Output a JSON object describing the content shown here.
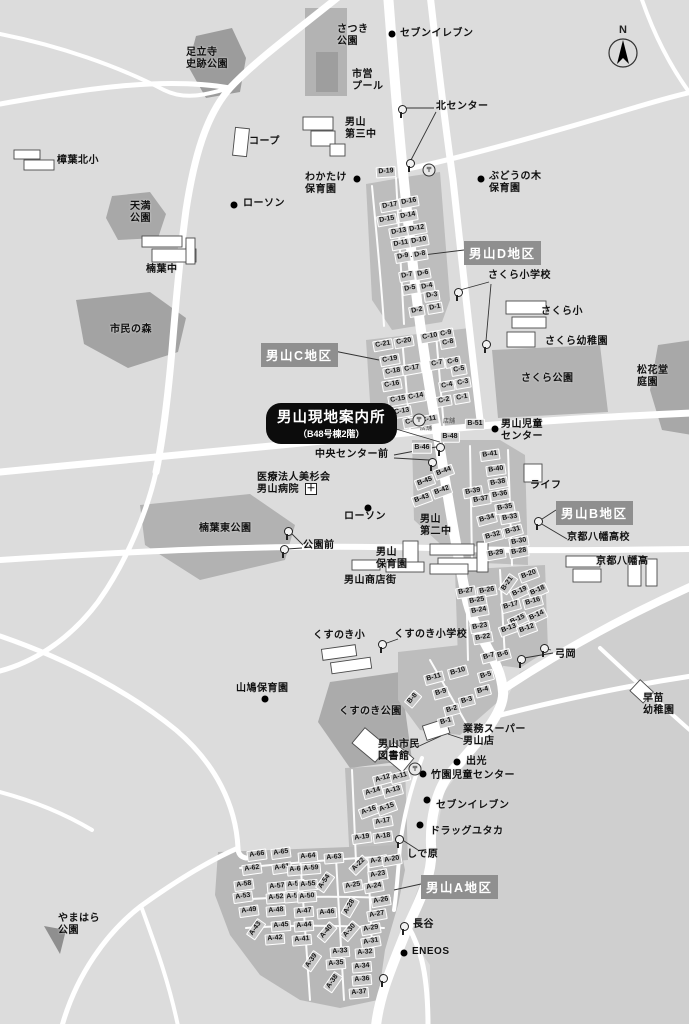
{
  "map": {
    "title": "男山地区 現地案内図",
    "compass_label": "N",
    "colors": {
      "background": "#dcdcdc",
      "road": "#ffffff",
      "park": "#a8a8a8",
      "housing_area": "#bdbdbd",
      "block_chip": "#c7c7c7",
      "district_badge": "#8f8f8f",
      "info_badge": "#0c0c0c",
      "text": "#111111"
    },
    "info_badge": {
      "line1": "男山現地案内所",
      "line2": "（B48号棟2階）"
    },
    "district_badges": [
      {
        "label": "男山D地区",
        "x": 464,
        "y": 241
      },
      {
        "label": "男山C地区",
        "x": 261,
        "y": 343
      },
      {
        "label": "男山B地区",
        "x": 556,
        "y": 501
      },
      {
        "label": "男山A地区",
        "x": 421,
        "y": 875
      }
    ],
    "places": [
      [
        "さつき\n公園",
        337,
        24
      ],
      [
        "セブンイレブン",
        400,
        28
      ],
      [
        "市営\nプール",
        352,
        69
      ],
      [
        "足立寺\n史跡公園",
        186,
        47
      ],
      [
        "北センター",
        436,
        101
      ],
      [
        "男山\n第三中",
        345,
        117
      ],
      [
        "コープ",
        249,
        136
      ],
      [
        "樟葉北小",
        57,
        155
      ],
      [
        "わかたけ\n保育園",
        305,
        172
      ],
      [
        "ローソン",
        243,
        198
      ],
      [
        "ぶどうの木\n保育園",
        489,
        171
      ],
      [
        "天満\n公園",
        130,
        201
      ],
      [
        "楠葉中",
        146,
        264
      ],
      [
        "市民の森",
        110,
        324
      ],
      [
        "さくら小学校",
        488,
        270
      ],
      [
        "さくら小",
        541,
        306
      ],
      [
        "さくら幼稚園",
        545,
        336
      ],
      [
        "さくら公園",
        521,
        373
      ],
      [
        "松花堂\n庭園",
        637,
        365
      ],
      [
        "男山児童\nセンター",
        501,
        419
      ],
      [
        "中央センター前",
        315,
        449
      ],
      [
        "ライフ",
        530,
        480
      ],
      [
        "医療法人美杉会\n男山病院",
        257,
        472
      ],
      [
        "京都八幡高校",
        567,
        532
      ],
      [
        "京都八幡高",
        596,
        556
      ],
      [
        "楠葉東公園",
        199,
        523
      ],
      [
        "公園前",
        303,
        540
      ],
      [
        "ローソン",
        344,
        511
      ],
      [
        "男山\n第二中",
        420,
        514
      ],
      [
        "男山\n保育園",
        376,
        547
      ],
      [
        "男山商店街",
        344,
        575
      ],
      [
        "くすのき小",
        313,
        630
      ],
      [
        "くすのき小学校",
        394,
        629
      ],
      [
        "弓岡",
        555,
        649
      ],
      [
        "山鳩保育園",
        236,
        683
      ],
      [
        "くすのき公園",
        339,
        706
      ],
      [
        "早苗\n幼稚園",
        643,
        693
      ],
      [
        "男山市民\n図書館",
        378,
        739
      ],
      [
        "業務スーパー\n男山店",
        463,
        724
      ],
      [
        "出光",
        466,
        756
      ],
      [
        "竹園児童センター",
        431,
        770
      ],
      [
        "セブンイレブン",
        436,
        800
      ],
      [
        "ドラッグユタカ",
        430,
        826
      ],
      [
        "しで原",
        407,
        849
      ],
      [
        "長谷",
        413,
        919
      ],
      [
        "ENEOS",
        412,
        946
      ],
      [
        "やまはら\n公園",
        58,
        913
      ],
      [
        "店舗",
        420,
        426,
        6
      ],
      [
        "店舗",
        443,
        419,
        6
      ]
    ],
    "poi_dots": [
      [
        392,
        34
      ],
      [
        357,
        179
      ],
      [
        234,
        205
      ],
      [
        481,
        179
      ],
      [
        495,
        429
      ],
      [
        368,
        508
      ],
      [
        265,
        699
      ],
      [
        457,
        762
      ],
      [
        423,
        774
      ],
      [
        427,
        800
      ],
      [
        420,
        825
      ],
      [
        404,
        953
      ]
    ],
    "bus_stops": [
      [
        401,
        108
      ],
      [
        409,
        162
      ],
      [
        457,
        291
      ],
      [
        485,
        343
      ],
      [
        439,
        446
      ],
      [
        431,
        461
      ],
      [
        287,
        530
      ],
      [
        283,
        548
      ],
      [
        381,
        643
      ],
      [
        520,
        658
      ],
      [
        543,
        647
      ],
      [
        398,
        838
      ],
      [
        403,
        925
      ],
      [
        382,
        977
      ],
      [
        537,
        520
      ]
    ],
    "post_offices": [
      [
        429,
        170
      ],
      [
        419,
        420
      ],
      [
        415,
        769
      ]
    ],
    "hospital_cross": {
      "x": 311,
      "y": 489,
      "glyph": "＋"
    },
    "callout_lines": [
      [
        434,
        108,
        406,
        108
      ],
      [
        436,
        112,
        411,
        160
      ],
      [
        489,
        282,
        460,
        290
      ],
      [
        491,
        284,
        486,
        341
      ],
      [
        396,
        429,
        443,
        443
      ],
      [
        394,
        455,
        436,
        447
      ],
      [
        394,
        458,
        429,
        460
      ],
      [
        303,
        545,
        290,
        532
      ],
      [
        302,
        548,
        287,
        549
      ],
      [
        398,
        639,
        384,
        644
      ],
      [
        553,
        653,
        524,
        658
      ],
      [
        551,
        650,
        544,
        648
      ],
      [
        567,
        539,
        540,
        523
      ],
      [
        418,
        850,
        401,
        839
      ],
      [
        417,
        747,
        441,
        736
      ],
      [
        463,
        739,
        448,
        734
      ],
      [
        421,
        884,
        394,
        890
      ],
      [
        464,
        250,
        407,
        257
      ],
      [
        334,
        351,
        379,
        360
      ],
      [
        556,
        510,
        539,
        521
      ]
    ],
    "blocks": {
      "D": [
        [
          "D-19",
          386,
          172,
          -4
        ],
        [
          "D-17",
          390,
          206,
          -10
        ],
        [
          "D-16",
          409,
          202,
          -10
        ],
        [
          "D-15",
          387,
          220,
          -10
        ],
        [
          "D-14",
          408,
          216,
          -10
        ],
        [
          "D-13",
          399,
          232,
          -10
        ],
        [
          "D-12",
          417,
          229,
          -10
        ],
        [
          "D-11",
          401,
          244,
          -10
        ],
        [
          "D-10",
          419,
          241,
          -10
        ],
        [
          "D-9",
          403,
          257,
          -10
        ],
        [
          "D-8",
          420,
          255,
          -10
        ],
        [
          "D-7",
          407,
          276,
          -10
        ],
        [
          "D-6",
          423,
          274,
          -10
        ],
        [
          "D-5",
          410,
          289,
          -10
        ],
        [
          "D-4",
          427,
          287,
          -10
        ],
        [
          "D-3",
          432,
          296,
          -8
        ],
        [
          "D-2",
          417,
          311,
          -10
        ],
        [
          "D-1",
          435,
          308,
          -10
        ]
      ],
      "C": [
        [
          "C-21",
          383,
          345,
          -10
        ],
        [
          "C-20",
          404,
          342,
          -10
        ],
        [
          "C-10",
          430,
          337,
          -10
        ],
        [
          "C-9",
          446,
          334,
          -10
        ],
        [
          "C-8",
          448,
          343,
          -10
        ],
        [
          "C-19",
          390,
          360,
          -10
        ],
        [
          "C-18",
          393,
          372,
          -10
        ],
        [
          "C-17",
          412,
          369,
          -10
        ],
        [
          "C-7",
          437,
          364,
          -10
        ],
        [
          "C-6",
          453,
          362,
          -10
        ],
        [
          "C-5",
          459,
          370,
          -10
        ],
        [
          "C-16",
          392,
          385,
          -10
        ],
        [
          "C-15",
          398,
          400,
          -10
        ],
        [
          "C-14",
          416,
          397,
          -10
        ],
        [
          "C-4",
          447,
          386,
          -10
        ],
        [
          "C-3",
          463,
          383,
          -10
        ],
        [
          "C-2",
          444,
          401,
          -10
        ],
        [
          "C-1",
          462,
          398,
          -10
        ],
        [
          "C-13",
          402,
          412,
          -10
        ],
        [
          "C-12",
          413,
          422,
          -10
        ],
        [
          "C-11",
          429,
          420,
          -10
        ]
      ],
      "B": [
        [
          "B-51",
          475,
          424,
          0
        ],
        [
          "B-48",
          450,
          437,
          0
        ],
        [
          "B-46",
          422,
          448,
          0
        ],
        [
          "B-45",
          425,
          482,
          -20
        ],
        [
          "B-44",
          444,
          472,
          -20
        ],
        [
          "B-43",
          422,
          499,
          -20
        ],
        [
          "B-42",
          442,
          491,
          -20
        ],
        [
          "B-41",
          490,
          455,
          -8
        ],
        [
          "B-40",
          496,
          470,
          -8
        ],
        [
          "B-39",
          473,
          492,
          -10
        ],
        [
          "B-38",
          498,
          483,
          -10
        ],
        [
          "B-37",
          481,
          500,
          -10
        ],
        [
          "B-36",
          500,
          495,
          -10
        ],
        [
          "B-35",
          505,
          508,
          -10
        ],
        [
          "B-34",
          487,
          519,
          -15
        ],
        [
          "B-33",
          510,
          518,
          -10
        ],
        [
          "B-32",
          493,
          536,
          -15
        ],
        [
          "B-31",
          513,
          531,
          -15
        ],
        [
          "B-30",
          519,
          542,
          -10
        ],
        [
          "B-29",
          496,
          554,
          -10
        ],
        [
          "B-28",
          519,
          552,
          -10
        ],
        [
          "B-27",
          466,
          592,
          -10
        ],
        [
          "B-26",
          487,
          591,
          -10
        ],
        [
          "B-25",
          477,
          601,
          -10
        ],
        [
          "B-24",
          479,
          611,
          -10
        ],
        [
          "B-23",
          480,
          627,
          -10
        ],
        [
          "B-22",
          483,
          638,
          -10
        ],
        [
          "B-21",
          508,
          584,
          -55
        ],
        [
          "B-20",
          529,
          575,
          -20
        ],
        [
          "B-19",
          520,
          592,
          -25
        ],
        [
          "B-18",
          538,
          591,
          -25
        ],
        [
          "B-17",
          511,
          606,
          -15
        ],
        [
          "B-16",
          533,
          602,
          -15
        ],
        [
          "B-15",
          518,
          620,
          -25
        ],
        [
          "B-14",
          537,
          616,
          -25
        ],
        [
          "B-13",
          509,
          629,
          -20
        ],
        [
          "B-12",
          527,
          629,
          -20
        ],
        [
          "B-7",
          489,
          657,
          -15
        ],
        [
          "B-6",
          503,
          655,
          -15
        ],
        [
          "B-11",
          434,
          678,
          -15
        ],
        [
          "B-10",
          458,
          672,
          -15
        ],
        [
          "B-5",
          486,
          676,
          -15
        ],
        [
          "B-9",
          441,
          693,
          -15
        ],
        [
          "B-4",
          483,
          691,
          -15
        ],
        [
          "B-8",
          413,
          699,
          -50
        ],
        [
          "B-3",
          467,
          701,
          -15
        ],
        [
          "B-2",
          452,
          710,
          -15
        ],
        [
          "B-1",
          446,
          722,
          -15
        ]
      ],
      "A": [
        [
          "A-12",
          383,
          779,
          -15
        ],
        [
          "A-11",
          400,
          777,
          -15
        ],
        [
          "A-14",
          373,
          792,
          -15
        ],
        [
          "A-13",
          393,
          791,
          -15
        ],
        [
          "A-16",
          369,
          811,
          -20
        ],
        [
          "A-15",
          387,
          808,
          -20
        ],
        [
          "A-17",
          383,
          822,
          -10
        ],
        [
          "A-19",
          362,
          838,
          -8
        ],
        [
          "A-18",
          383,
          837,
          -8
        ],
        [
          "A-22",
          359,
          865,
          -45
        ],
        [
          "A-21",
          378,
          861,
          -10
        ],
        [
          "A-20",
          392,
          860,
          -10
        ],
        [
          "A-66",
          257,
          855,
          -8
        ],
        [
          "A-65",
          281,
          853,
          -8
        ],
        [
          "A-64",
          308,
          857,
          -5
        ],
        [
          "A-63",
          334,
          858,
          -5
        ],
        [
          "A-62",
          252,
          869,
          -8
        ],
        [
          "A-61",
          282,
          868,
          -8
        ],
        [
          "A-60",
          297,
          870,
          -5
        ],
        [
          "A-59",
          311,
          869,
          -5
        ],
        [
          "A-23",
          378,
          875,
          -10
        ],
        [
          "A-58",
          244,
          885,
          -8
        ],
        [
          "A-57",
          277,
          887,
          -5
        ],
        [
          "A-56",
          295,
          885,
          -5
        ],
        [
          "A-55",
          308,
          885,
          -5
        ],
        [
          "A-54",
          325,
          882,
          -55
        ],
        [
          "A-25",
          353,
          886,
          -10
        ],
        [
          "A-24",
          374,
          887,
          -10
        ],
        [
          "A-53",
          243,
          897,
          -8
        ],
        [
          "A-52",
          276,
          898,
          -5
        ],
        [
          "A-51",
          294,
          897,
          -5
        ],
        [
          "A-50",
          307,
          897,
          -5
        ],
        [
          "A-26",
          381,
          901,
          -10
        ],
        [
          "A-49",
          249,
          911,
          -8
        ],
        [
          "A-48",
          276,
          911,
          -5
        ],
        [
          "A-47",
          304,
          912,
          -5
        ],
        [
          "A-46",
          327,
          913,
          -5
        ],
        [
          "A-28",
          350,
          907,
          -60
        ],
        [
          "A-27",
          377,
          915,
          -10
        ],
        [
          "A-43",
          256,
          929,
          -55
        ],
        [
          "A-45",
          281,
          926,
          -5
        ],
        [
          "A-44",
          304,
          926,
          -5
        ],
        [
          "A-40",
          327,
          932,
          -50
        ],
        [
          "A-30",
          350,
          931,
          -50
        ],
        [
          "A-29",
          371,
          929,
          -10
        ],
        [
          "A-42",
          275,
          939,
          -5
        ],
        [
          "A-41",
          302,
          940,
          -5
        ],
        [
          "A-31",
          371,
          942,
          -10
        ],
        [
          "A-33",
          340,
          952,
          -5
        ],
        [
          "A-32",
          365,
          953,
          -5
        ],
        [
          "A-39",
          312,
          961,
          -55
        ],
        [
          "A-35",
          336,
          964,
          -5
        ],
        [
          "A-34",
          362,
          967,
          -5
        ],
        [
          "A-38",
          333,
          982,
          -55
        ],
        [
          "A-36",
          362,
          980,
          -5
        ],
        [
          "A-37",
          359,
          993,
          -5
        ]
      ]
    }
  }
}
